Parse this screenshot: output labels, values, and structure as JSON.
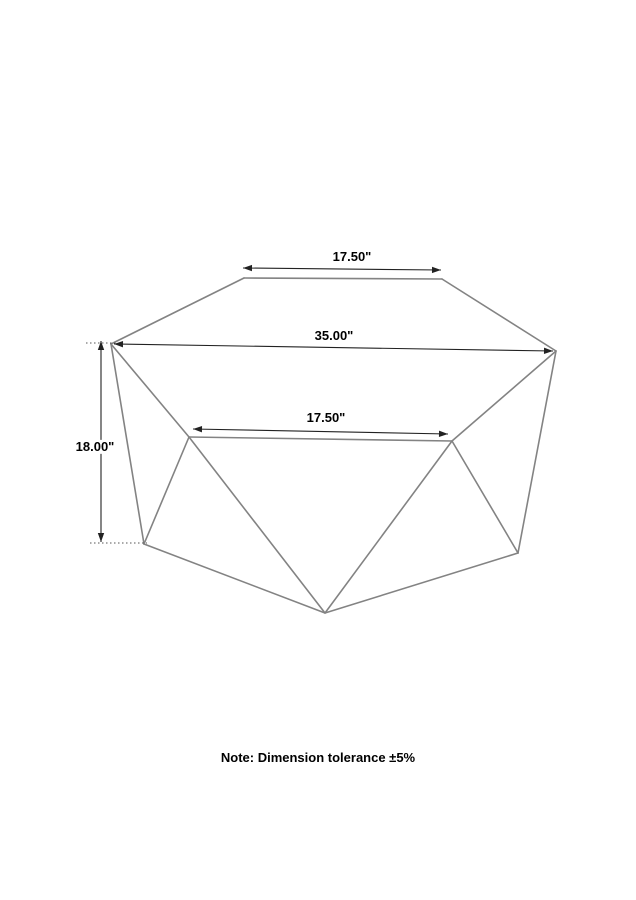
{
  "diagram": {
    "note": "Note: Dimension tolerance ±5%",
    "colors": {
      "background": "#ffffff",
      "edge": "#838383",
      "dimension": "#222222",
      "extension": "#555555",
      "text": "#000000"
    },
    "canvas": {
      "width": 636,
      "height": 900
    },
    "vertices": {
      "left": [
        111,
        344
      ],
      "top_left": [
        244,
        278
      ],
      "top_right": [
        442,
        279
      ],
      "right": [
        556,
        351
      ],
      "front_left": [
        189,
        437
      ],
      "front_right": [
        452,
        441
      ],
      "bottom_left": [
        144,
        544
      ],
      "bottom_center": [
        325,
        613
      ],
      "bottom_right": [
        518,
        553
      ]
    },
    "edges": [
      [
        "left",
        "top_left"
      ],
      [
        "top_left",
        "top_right"
      ],
      [
        "top_right",
        "right"
      ],
      [
        "right",
        "front_right"
      ],
      [
        "front_right",
        "front_left"
      ],
      [
        "front_left",
        "left"
      ],
      [
        "left",
        "bottom_left"
      ],
      [
        "front_left",
        "bottom_left"
      ],
      [
        "front_left",
        "bottom_center"
      ],
      [
        "front_right",
        "bottom_center"
      ],
      [
        "front_right",
        "bottom_right"
      ],
      [
        "right",
        "bottom_right"
      ],
      [
        "bottom_left",
        "bottom_center"
      ],
      [
        "bottom_center",
        "bottom_right"
      ]
    ],
    "dimensions": [
      {
        "id": "dim-top-width",
        "label": "17.50\"",
        "from": [
          243,
          268
        ],
        "to": [
          441,
          270
        ],
        "label_pos": [
          352,
          257
        ]
      },
      {
        "id": "dim-overall-width",
        "label": "35.00\"",
        "from": [
          114,
          344
        ],
        "to": [
          553,
          351
        ],
        "label_pos": [
          334,
          336
        ]
      },
      {
        "id": "dim-front-width",
        "label": "17.50\"",
        "from": [
          193,
          429
        ],
        "to": [
          448,
          434
        ],
        "label_pos": [
          326,
          418
        ]
      },
      {
        "id": "dim-height",
        "label": "18.00\"",
        "from": [
          101,
          341
        ],
        "to": [
          101,
          542
        ],
        "label_pos": [
          95,
          447
        ]
      }
    ],
    "extension_lines": [
      {
        "from": [
          86,
          343
        ],
        "to": [
          116,
          343
        ]
      },
      {
        "from": [
          90,
          543
        ],
        "to": [
          147,
          543
        ]
      }
    ]
  }
}
